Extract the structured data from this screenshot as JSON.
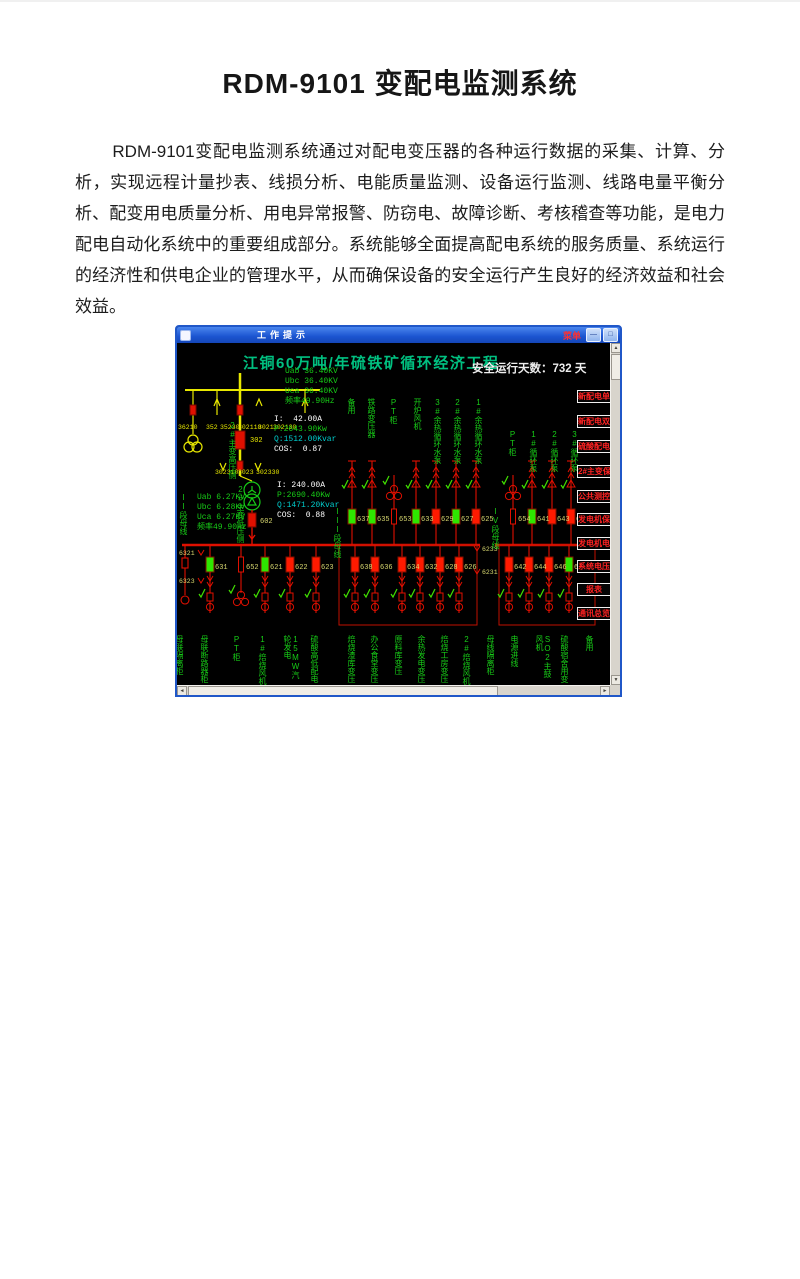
{
  "doc": {
    "title": "RDM-9101 变配电监测系统",
    "paragraph": "RDM-9101变配电监测系统通过对配电变压器的各种运行数据的采集、计算、分析，实现远程计量抄表、线损分析、电能质量监测、设备运行监测、线路电量平衡分析、配变用电质量分析、用电异常报警、防窃电、故障诊断、考核稽查等功能，是电力配电自动化系统中的重要组成部分。系统能够全面提高配电系统的服务质量、系统运行的经济性和供电企业的管理水平，从而确保设备的安全运行产生良好的经济效益和社会效益。"
  },
  "window": {
    "title": "工作提示",
    "menu_label": "菜单",
    "minimize_glyph": "—",
    "maximize_glyph": "□"
  },
  "screen": {
    "title": "江铜60万吨/年硫铁矿循环经济工程",
    "safe_days_label": "安全运行天数：",
    "safe_days_value": "732",
    "safe_days_unit": "天"
  },
  "colors": {
    "screen_title": "#00c080",
    "label_green": "#17cc17",
    "wire_yellow": "#e8e800",
    "wire_red": "#e01000",
    "breaker_closed_green": "#2ee600",
    "breaker_open_red": "#ff1a00",
    "value_cyan": "#00cccc",
    "value_white": "#ffffff",
    "id_yellow": "#d8d870",
    "button_red": "#ff2222"
  },
  "diagram": {
    "hv_voltage_lines": [
      {
        "text": "Uab 36.40KV",
        "color": "#17cc17"
      },
      {
        "text": "Ubc 36.40KV",
        "color": "#17cc17"
      },
      {
        "text": "Uca 36.40KV",
        "color": "#17cc17"
      },
      {
        "text": "频率49.90Hz",
        "color": "#17cc17"
      }
    ],
    "hv_measure_lines": [
      {
        "text": "I:  42.00A",
        "color": "#ffffff"
      },
      {
        "text": "P:2643.90Kw",
        "color": "#17cc17"
      },
      {
        "text": "Q:1512.00Kvar",
        "color": "#00cccc"
      },
      {
        "text": "COS:  0.87",
        "color": "#ffffff"
      }
    ],
    "lv_measure_lines": [
      {
        "text": "I: 240.00A",
        "color": "#ffffff"
      },
      {
        "text": "P:2690.40Kw",
        "color": "#17cc17"
      },
      {
        "text": "Q:1471.20Kvar",
        "color": "#00cccc"
      },
      {
        "text": "COS:  0.88",
        "color": "#ffffff"
      }
    ],
    "lv_voltage_lines": [
      {
        "text": "Uab 6.27KV",
        "color": "#17cc17"
      },
      {
        "text": "Ubc 6.28KV",
        "color": "#17cc17"
      },
      {
        "text": "Uca 6.27KV",
        "color": "#17cc17"
      },
      {
        "text": "频率49.90Hz",
        "color": "#17cc17"
      }
    ],
    "hv_transformer_side_label": "2#主变高压侧",
    "lv_transformer_side_label": "2#主变低压侧",
    "bus2_label": "II段母线",
    "bus3_label": "III段母线",
    "bus4_label": "IV段母线",
    "hv_breaker_id": "302",
    "lv_breaker_id": "602",
    "hv_switch_row1": [
      {
        "x": 1,
        "t": "36210"
      },
      {
        "x": 29,
        "t": "352"
      },
      {
        "x": 43,
        "t": "35230"
      },
      {
        "x": 61,
        "t": "302110"
      },
      {
        "x": 81,
        "t": "3021"
      },
      {
        "x": 96,
        "t": "302130"
      }
    ],
    "hv_switch_row2": [
      {
        "x": 38,
        "t": "302310"
      },
      {
        "x": 61,
        "t": "3023"
      },
      {
        "x": 79,
        "t": "302330"
      }
    ],
    "left_bus_tags": [
      {
        "y": 212,
        "t": "6321"
      },
      {
        "y": 240,
        "t": "6323"
      }
    ],
    "mid_bus_tags": [
      {
        "y": 208,
        "t": "6233"
      },
      {
        "y": 231,
        "t": "6231"
      }
    ],
    "upper_feeders": [
      {
        "x": 175,
        "id": "637",
        "state": "green",
        "kind": "motor"
      },
      {
        "x": 195,
        "id": "635",
        "state": "green",
        "kind": "motor"
      },
      {
        "x": 217,
        "id": "653",
        "state": "none",
        "kind": "pt"
      },
      {
        "x": 239,
        "id": "633",
        "state": "green",
        "kind": "motor"
      },
      {
        "x": 259,
        "id": "629",
        "state": "red",
        "kind": "motor"
      },
      {
        "x": 279,
        "id": "627",
        "state": "green",
        "kind": "motor"
      },
      {
        "x": 299,
        "id": "625",
        "state": "red",
        "kind": "motor"
      },
      {
        "x": 336,
        "id": "654",
        "state": "none",
        "kind": "pt"
      },
      {
        "x": 355,
        "id": "641",
        "state": "green",
        "kind": "motor"
      },
      {
        "x": 375,
        "id": "643",
        "state": "red",
        "kind": "motor"
      },
      {
        "x": 394,
        "id": "645",
        "state": "red",
        "kind": "motor"
      }
    ],
    "upper_labels": [
      {
        "x": 175,
        "y": 55,
        "t": "备用"
      },
      {
        "x": 195,
        "y": 55,
        "t": "铁路变压器"
      },
      {
        "x": 217,
        "y": 55,
        "t": "PT柜"
      },
      {
        "x": 241,
        "y": 55,
        "t": "开炉风机"
      },
      {
        "x": 261,
        "y": 55,
        "t": "3#余热循环水泵"
      },
      {
        "x": 281,
        "y": 55,
        "t": "2#余热循环水泵"
      },
      {
        "x": 302,
        "y": 55,
        "t": "1#余热循环水泵"
      },
      {
        "x": 336,
        "y": 87,
        "t": "PT柜"
      },
      {
        "x": 357,
        "y": 87,
        "t": "1#循环泵"
      },
      {
        "x": 378,
        "y": 87,
        "t": "2#循环泵"
      },
      {
        "x": 398,
        "y": 87,
        "t": "3#循环泵"
      }
    ],
    "lower_left_feeders": [
      {
        "x": 33,
        "id": "631",
        "state": "green",
        "kind": "motor"
      },
      {
        "x": 64,
        "id": "652",
        "state": "none",
        "kind": "tx"
      },
      {
        "x": 88,
        "id": "621",
        "state": "green",
        "kind": "motor"
      },
      {
        "x": 113,
        "id": "622",
        "state": "red",
        "kind": "motor"
      },
      {
        "x": 139,
        "id": "623",
        "state": "red",
        "kind": "motor"
      }
    ],
    "lower_mid_feeders": [
      {
        "x": 178,
        "id": "638",
        "state": "red",
        "kind": "motor"
      },
      {
        "x": 198,
        "id": "636",
        "state": "red",
        "kind": "motor"
      },
      {
        "x": 225,
        "id": "634",
        "state": "red",
        "kind": "motor"
      },
      {
        "x": 243,
        "id": "632",
        "state": "red",
        "kind": "motor"
      },
      {
        "x": 263,
        "id": "628",
        "state": "red",
        "kind": "motor"
      },
      {
        "x": 282,
        "id": "626",
        "state": "red",
        "kind": "motor"
      }
    ],
    "lower_right_feeders": [
      {
        "x": 332,
        "id": "642",
        "state": "red",
        "kind": "motor"
      },
      {
        "x": 352,
        "id": "644",
        "state": "red",
        "kind": "motor"
      },
      {
        "x": 372,
        "id": "646",
        "state": "red",
        "kind": "motor"
      },
      {
        "x": 392,
        "id": "648",
        "state": "green",
        "kind": "motor"
      }
    ],
    "bottom_labels": [
      {
        "x": 3,
        "t": "母联隔离柜"
      },
      {
        "x": 28,
        "t": "母联断路器柜"
      },
      {
        "x": 60,
        "t": "PT柜"
      },
      {
        "x": 86,
        "t": "1#焙烧风机"
      },
      {
        "x": 111,
        "t": "15MW汽轮发电"
      },
      {
        "x": 138,
        "t": "硫酸高低配电"
      },
      {
        "x": 175,
        "t": "焙烧渣库变压"
      },
      {
        "x": 198,
        "t": "办公食堂变压"
      },
      {
        "x": 222,
        "t": "原料库变压"
      },
      {
        "x": 245,
        "t": "余热发电变压"
      },
      {
        "x": 268,
        "t": "焙烧工房变压"
      },
      {
        "x": 290,
        "t": "2#焙烧风机"
      },
      {
        "x": 314,
        "t": "母线隔离柜"
      },
      {
        "x": 338,
        "t": "电源进线"
      },
      {
        "x": 363,
        "t": "SO2主鼓风机"
      },
      {
        "x": 388,
        "t": "硫酸宿舍用变"
      },
      {
        "x": 413,
        "t": "备用"
      }
    ],
    "menu_buttons": [
      {
        "y": 47,
        "t": "新配电单屏"
      },
      {
        "y": 72,
        "t": "新配电双屏"
      },
      {
        "y": 97,
        "t": "硫酸配电"
      },
      {
        "y": 122,
        "t": "2#主变保护"
      },
      {
        "y": 147,
        "t": "公共测控"
      },
      {
        "y": 170,
        "t": "发电机保护"
      },
      {
        "y": 194,
        "t": "发电机电压"
      },
      {
        "y": 217,
        "t": "系统电压"
      },
      {
        "y": 240,
        "t": "报表"
      },
      {
        "y": 264,
        "t": "通讯总览"
      }
    ]
  }
}
